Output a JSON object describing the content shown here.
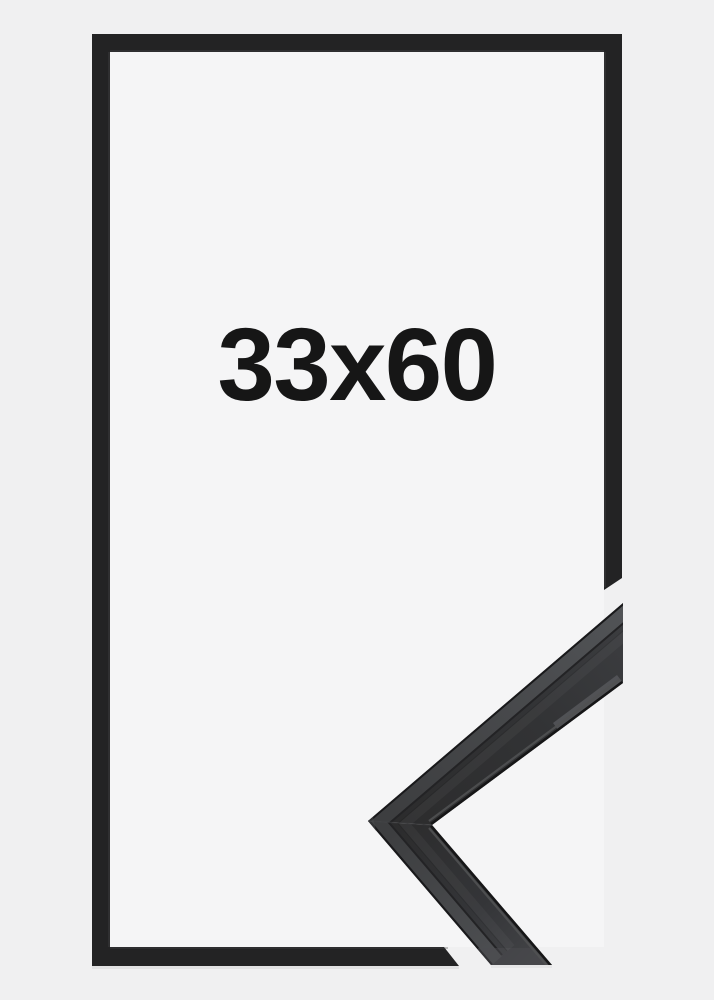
{
  "frame": {
    "size_label": "33x60"
  },
  "colors": {
    "background": "#f0f0f1",
    "frame_interior": "#f5f5f6",
    "frame_black": "#232324",
    "outline_inner_highlight": "#4a4a4c",
    "label_text": "#161616",
    "photo_face_dark": "#2c2c2d",
    "photo_face_light": "#3c3d40",
    "photo_stripe_dark": "#3d3e40",
    "photo_stripe_light": "#515356",
    "photo_edge_dark": "#19191b",
    "photo_inner_edge": "#161617",
    "photo_lip_highlight": "#505153",
    "photo_underside_highlight": "#56575b",
    "shadow": "#dadadc"
  }
}
